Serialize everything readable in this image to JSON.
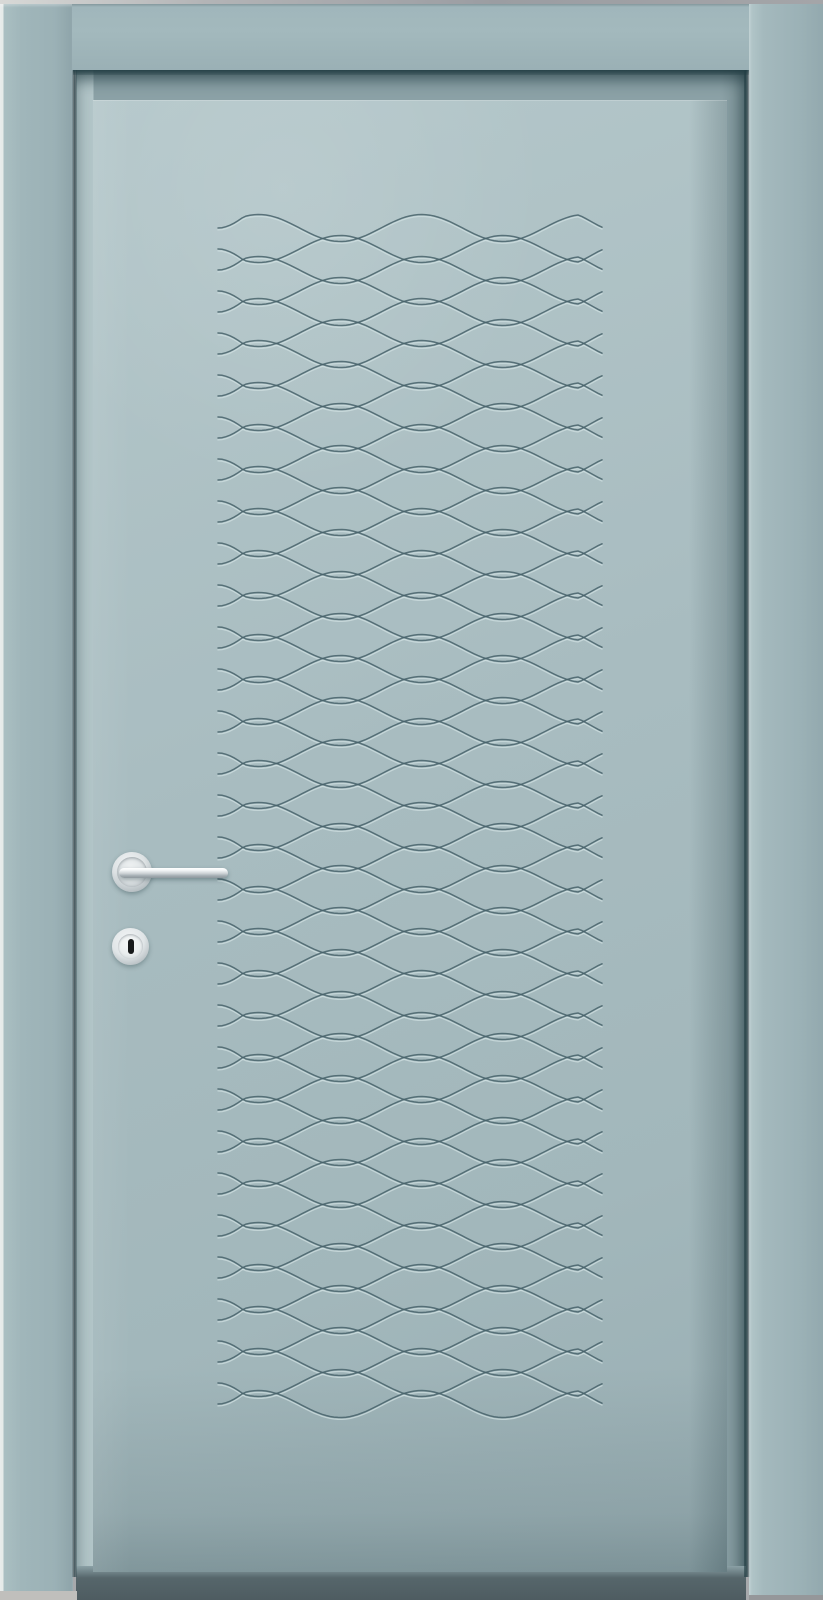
{
  "scene": {
    "subject": "closed interior door, front view",
    "style": "3d-product-render",
    "finish": "matte sage-teal lacquer",
    "decor": "horizontal engraved wave / braid pattern on center panel",
    "hardware": "polished stainless lever handle on round rose with separate round keyhole escutcheon",
    "handle_side": "left",
    "visible_text": ""
  },
  "palette": {
    "wall": "#a7a9ac",
    "floor-left": "#c0bfbc",
    "floor-right": "#95979a",
    "arch-hi": "#e6ebea",
    "jamb": "#8ba1a6",
    "jamb-hi": "#b2c5c8",
    "leaf-hi": "#b4c7ca",
    "leaf": "#a8bcc0",
    "leaf-sh": "#99aeb3",
    "under": "#56666b",
    "chrome-hi": "#f4f6f7",
    "chrome-mid": "#ccd2d5",
    "chrome-sh": "#8e989d",
    "slot": "#17191a"
  },
  "door": {
    "pattern": {
      "type": "engraved-sine-waves",
      "lines": 57,
      "line_spacing": 21,
      "amplitude": 13.5,
      "wavelength": 163,
      "x_start": 218,
      "x_end": 604,
      "y_start": 228,
      "end_taper": 26,
      "groove_dark": "#46626a",
      "groove_light": "#cfdfe0",
      "dark_width": 1.5,
      "light_width": 1.3,
      "light_offset": 1.9
    }
  }
}
